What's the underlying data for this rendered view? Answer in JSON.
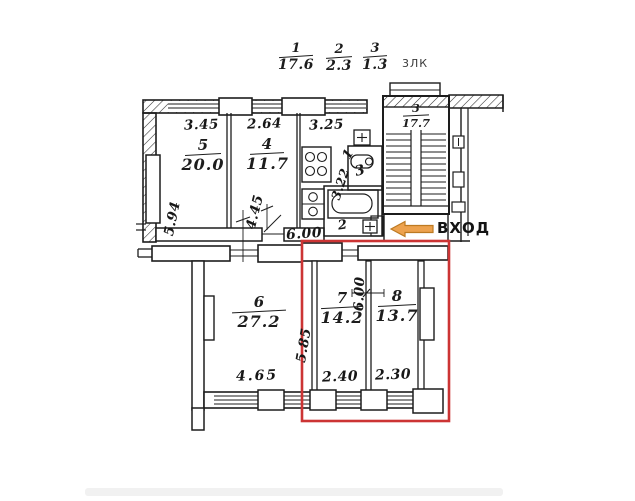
{
  "header": {
    "fractions": [
      {
        "num": "1",
        "den": "17.6"
      },
      {
        "num": "2",
        "den": "2.3"
      },
      {
        "num": "3",
        "den": "1.3"
      }
    ],
    "stair_abbr": "3ЛК"
  },
  "upper_unit": {
    "top_dims": [
      "3.45",
      "2.64",
      "3.25"
    ],
    "room5": {
      "number": "5",
      "area": "20.0"
    },
    "room4": {
      "number": "4",
      "area": "11.7"
    },
    "dim_left_wall": "5.94",
    "dim_room4_depth": "4.45",
    "kitchen": {
      "number": "1",
      "depth_dim": "3.22"
    },
    "toilet_number": "3",
    "bath_number": "2",
    "corridor_dim": "6.00"
  },
  "stairwell": {
    "number": "3",
    "area": "17.7"
  },
  "entrance": {
    "label": "ВХОД"
  },
  "lower_unit": {
    "room6": {
      "number": "6",
      "area": "27.2",
      "width_dim": "4.65"
    },
    "room7": {
      "number": "7",
      "area": "14.2",
      "width_dim": "2.40",
      "depth_dim": "6.00",
      "side_dim": "5.85"
    },
    "room8": {
      "number": "8",
      "area": "13.7",
      "width_dim": "2.30"
    }
  },
  "highlight_color": "#cc3434",
  "arrow_color": "#eda24e",
  "ink_color": "#1d1d1d"
}
